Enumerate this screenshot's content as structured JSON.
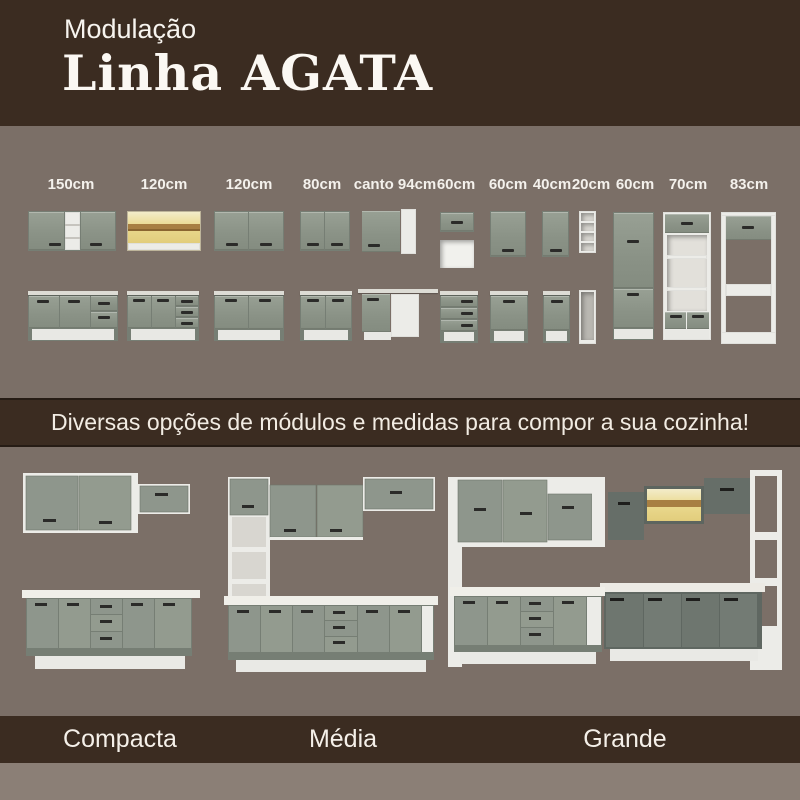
{
  "header": {
    "eyebrow": "Modulação",
    "title": "Linha AGATA"
  },
  "modules": {
    "labels": [
      "150cm",
      "120cm",
      "120cm",
      "80cm",
      "canto 94cm",
      "60cm",
      "60cm",
      "40cm",
      "20cm",
      "60cm",
      "70cm",
      "83cm"
    ]
  },
  "banner": {
    "text": "Diversas opções de módulos e medidas para compor a sua cozinha!"
  },
  "kitchens": [
    {
      "label": "Compacta"
    },
    {
      "label": "Média"
    },
    {
      "label": "Grande"
    }
  ],
  "colors": {
    "background": "#7b6f67",
    "band_brown": "#3b2c21",
    "cabinet_gray": "#8e968c",
    "cabinet_dark": "#6e766f",
    "white": "#ecece8",
    "glass_amber": "#ead98e",
    "wood": "#a87f42",
    "bottom_strip": "#8b7f76"
  }
}
